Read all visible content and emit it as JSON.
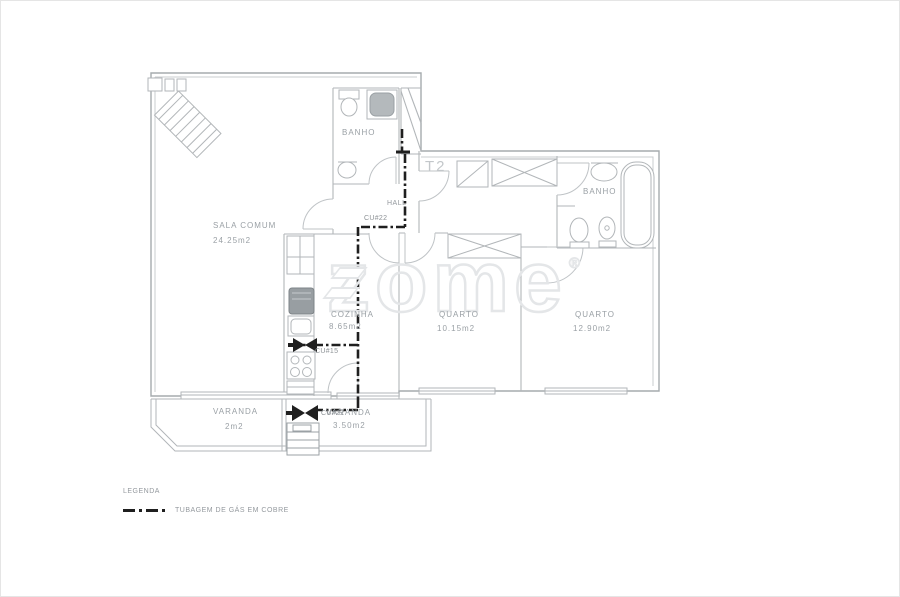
{
  "unit": {
    "type_label": "T2"
  },
  "watermark": {
    "brand": "zome",
    "registered": "®"
  },
  "rooms": {
    "sala": {
      "name": "SALA COMUM",
      "area": "24.25m2"
    },
    "banho_top": {
      "name": "BANHO"
    },
    "hall": {
      "name": "HALL"
    },
    "cozinha": {
      "name": "COZINHA",
      "area": "8.65m2"
    },
    "quarto_1": {
      "name": "QUARTO",
      "area": "10.15m2"
    },
    "quarto_2": {
      "name": "QUARTO",
      "area": "12.90m2"
    },
    "banho_suite": {
      "name": "BANHO"
    },
    "varanda_1": {
      "name": "VARANDA",
      "area": "2m2"
    },
    "varanda_2": {
      "name": "VARANDA",
      "area": "3.50m2"
    }
  },
  "gas_network": {
    "valves": {
      "hall": "CU#22",
      "cozinha": "CU#15",
      "varanda": "CU#22"
    }
  },
  "legend": {
    "title": "LEGENDA",
    "items": [
      {
        "symbol": "gas-dash-dot-line",
        "label": "TUBAGEM DE GÁS EM COBRE"
      }
    ]
  },
  "colors": {
    "plan_line": "#b2b6b9",
    "wall_line": "#a6abae",
    "gas_pipe": "#1f1f1f",
    "label_text": "#9aa0a5",
    "watermark": "#e4e6e8"
  }
}
